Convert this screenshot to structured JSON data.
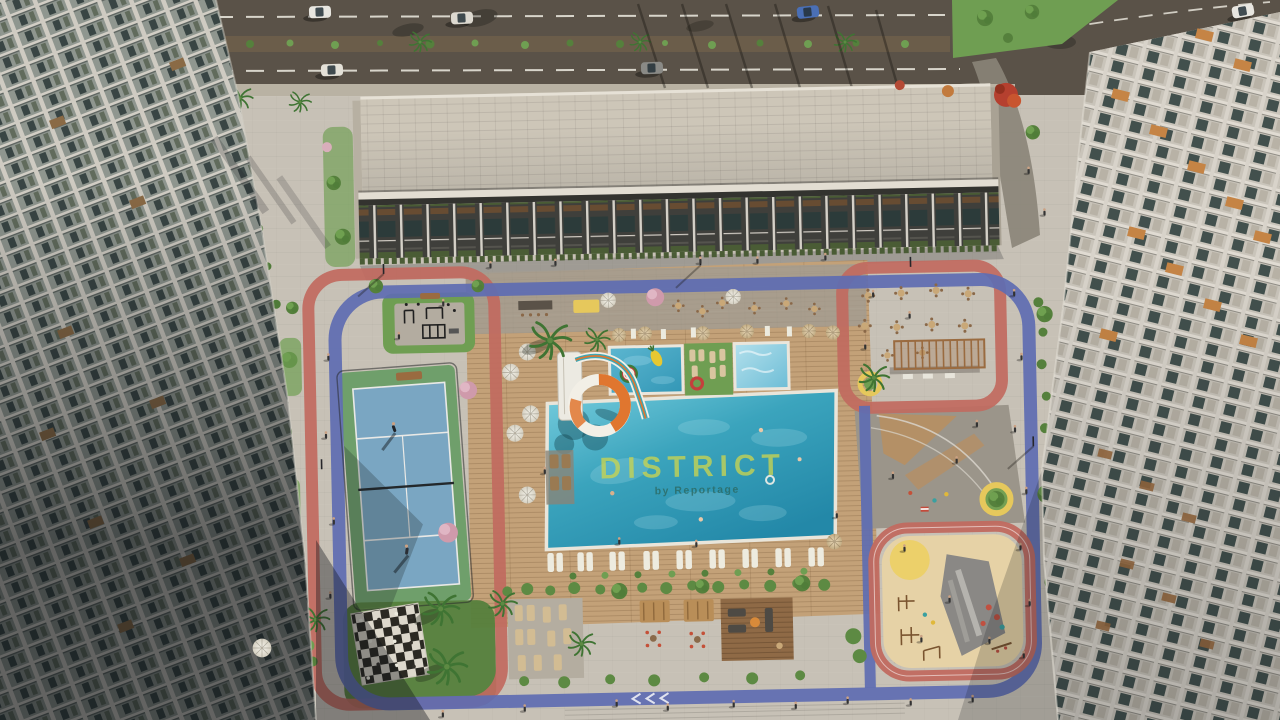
{
  "image": {
    "kind": "aerial architectural render",
    "alt": "Aerial view of a residential complex courtyard with swimming pools, padel court, giant chessboard, playground, outdoor gym and dining terraces between apartment towers"
  },
  "watermark": {
    "brand": "DISTRICT",
    "byline": "by Reportage"
  },
  "colors": {
    "pavement": "#c7c1b6",
    "asphalt": "#5a5248",
    "median": "#6b5d4a",
    "sidewalk": "#b9b2a3",
    "grass": "#6f9e52",
    "grassDark": "#55803c",
    "deck": "#c3a178",
    "deckDark": "#8f6a46",
    "trackRed": "#c16a60",
    "pathBlue": "#5e6cb2",
    "sand": "#e6d2a6",
    "courtBlue": "#7aa6c2",
    "courtGreen": "#6f9f6b",
    "roofLight": "#cdc6b8",
    "facadeDark": "#3f3f3b",
    "accentOrange": "#c58445",
    "woodBrown": "#9a6b40",
    "slideOrange": "#e0762f",
    "slideTeal": "#3fa7b5",
    "wmYellow": "#c9d451",
    "wmTeal": "#2c6a63",
    "yellowBench": "#e6c85c",
    "pinkTree": "#d9aebb",
    "redTree": "#b5402f",
    "canopyTan": "#b98e58",
    "chkD": "#2b2923",
    "chkL": "#ddd8cc",
    "poolDeep": "#2388a8",
    "poolLight": "#74cbdc"
  }
}
